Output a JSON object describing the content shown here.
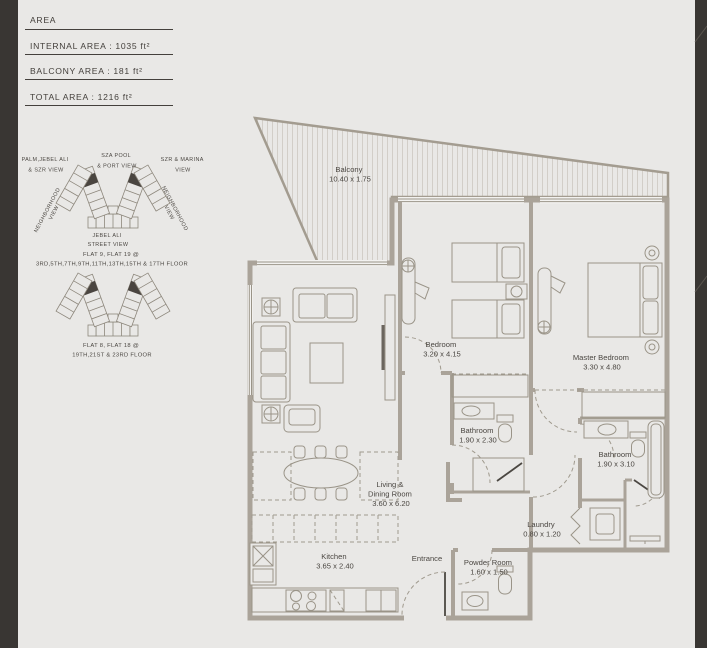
{
  "colors": {
    "background": "#e9e8e6",
    "wall": "#aaa399",
    "text": "#4b4742",
    "side_stripe": "#393633",
    "highlighted_unit": "#4a4540"
  },
  "area_table": {
    "title": "AREA",
    "rows": [
      "INTERNAL AREA : 1035 ft²",
      "BALCONY AREA : 181 ft²",
      "TOTAL AREA : 1216 ft²"
    ]
  },
  "location": {
    "views": {
      "palm": [
        "PALM,JEBEL ALI",
        "& SZR VIEW"
      ],
      "pool": [
        "SZA POOL",
        "& PORT VIEW"
      ],
      "marina": [
        "SZR & MARINA",
        "VIEW"
      ],
      "neighborhood_left": [
        "NEIGHBORHOOD",
        "VIEW"
      ],
      "neighborhood_right": [
        "NEIGHBORHOOD",
        "VIEW"
      ],
      "street": [
        "JEBEL ALI",
        "STREET VIEW"
      ]
    },
    "upper_caption": [
      "FLAT 9, FLAT 19 @",
      "3RD,5TH,7TH,9TH,11TH,13TH,15TH & 17TH FLOOR"
    ],
    "lower_caption": [
      "FLAT 8, FLAT 18 @",
      "19TH,21ST & 23RD FLOOR"
    ]
  },
  "rooms": {
    "balcony": {
      "name": "Balcony",
      "dim": "10.40 x 1.75"
    },
    "bedroom": {
      "name": "Bedroom",
      "dim": "3.20 x 4.15"
    },
    "master": {
      "name": "Master Bedroom",
      "dim": "3.30 x 4.80"
    },
    "bathroom1": {
      "name": "Bathroom",
      "dim": "1.90 x 2.30"
    },
    "bathroom2": {
      "name": "Bathroom",
      "dim": "1.90 x 3.10"
    },
    "living_dining": {
      "lines": [
        "Living &",
        "Dining Room"
      ],
      "dim": "3.60 x 6.20"
    },
    "laundry": {
      "name": "Laundry",
      "dim": "0.80 x 1.20"
    },
    "kitchen": {
      "name": "Kitchen",
      "dim": "3.65 x 2.40"
    },
    "entrance": {
      "name": "Entrance"
    },
    "powder": {
      "name": "Powder Room",
      "dim": "1.60 x 1.50"
    }
  }
}
